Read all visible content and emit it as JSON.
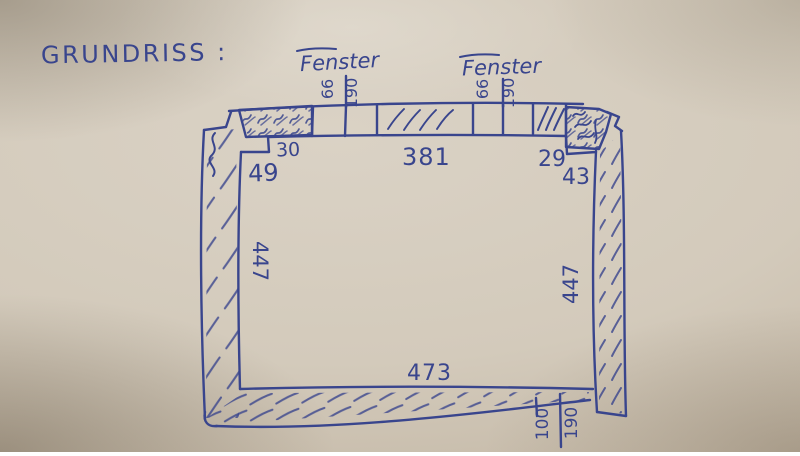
{
  "colors": {
    "ink": "#39458d",
    "paper": "#d3cabb"
  },
  "sketch": {
    "title": "GRUNDRISS :",
    "windows": {
      "left": {
        "label": "Fenster",
        "height": "66",
        "width": "190"
      },
      "right": {
        "label": "Fenster",
        "height": "66",
        "width": "190"
      }
    },
    "dimensions": {
      "top_left_pier": "49",
      "top_left_segment": "30",
      "top_span": "381",
      "top_right_segment": "29",
      "top_right_pier": "43",
      "left_wall": "447",
      "right_wall": "447",
      "bottom_span": "473",
      "opening_a": "100",
      "opening_b": "190"
    }
  }
}
